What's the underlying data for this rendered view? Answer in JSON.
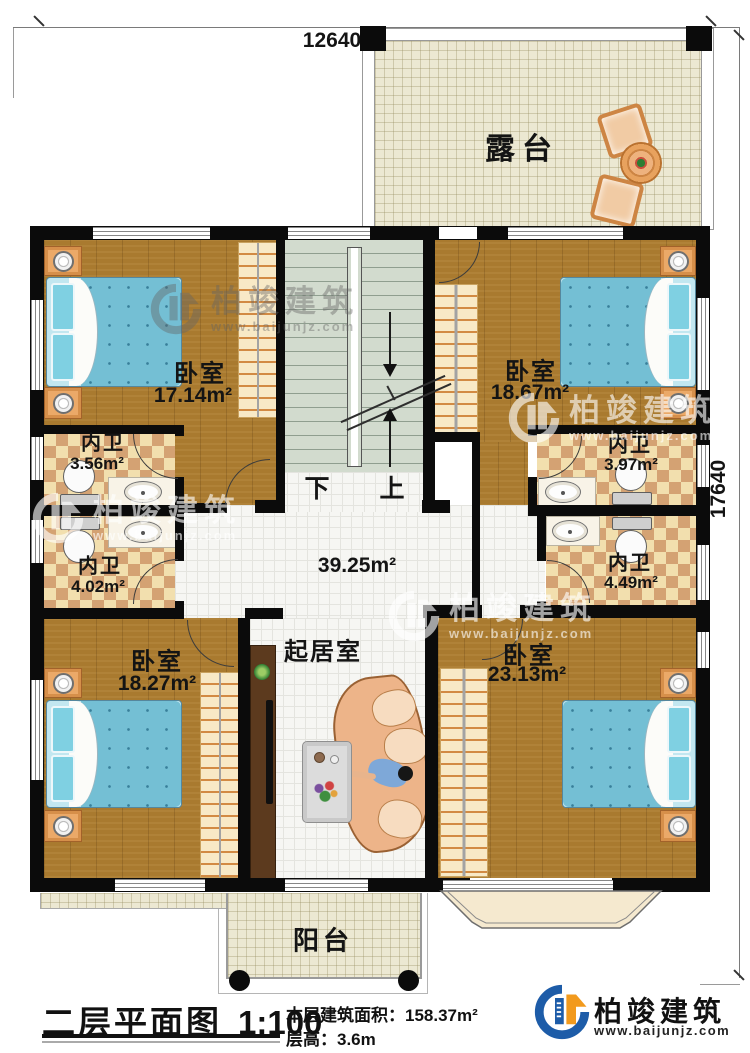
{
  "dimensions": {
    "width": "12640",
    "height": "17640"
  },
  "rooms": {
    "terrace": {
      "name": "露台"
    },
    "bedroom_top_left": {
      "name": "卧室",
      "area": "17.14m²"
    },
    "bedroom_top_right": {
      "name": "卧室",
      "area": "18.67m²"
    },
    "bath_left_upper": {
      "name": "内卫",
      "area": "3.56m²"
    },
    "bath_left_lower": {
      "name": "内卫",
      "area": "4.02m²"
    },
    "bath_right_upper": {
      "name": "内卫",
      "area": "3.97m²"
    },
    "bath_right_lower": {
      "name": "内卫",
      "area": "4.49m²"
    },
    "hall": {
      "area": "39.25m²"
    },
    "living_room": {
      "name": "起居室"
    },
    "bedroom_bottom_left": {
      "name": "卧室",
      "area": "18.27m²"
    },
    "bedroom_bottom_right": {
      "name": "卧室",
      "area": "23.13m²"
    },
    "balcony": {
      "name": "阳台"
    }
  },
  "stairs": {
    "down": "下",
    "up": "上"
  },
  "title_block": {
    "title": "二层平面图",
    "scale": "1:100",
    "floor_area_label": "本层建筑面积：",
    "floor_area_value": "158.37m²",
    "floor_height_label": "层高：",
    "floor_height_value": "3.6m"
  },
  "brand": {
    "name": "柏竣建筑",
    "website": "www.baijunjz.com"
  },
  "watermark": {
    "name": "柏竣建筑",
    "website": "www.baijunjz.com"
  },
  "colors": {
    "wall": "#0b0b0b",
    "wood_floor": "#a97a2f",
    "terrace_floor": "#ece8d2",
    "stair_floor": "#d2dbce",
    "bath_tile_dark": "#d4a273",
    "bath_tile_light": "#f2dfae",
    "bed_blue": "#74bfd4",
    "furniture_orange": "#eba968",
    "logo_blue": "#1d5ca8",
    "logo_orange": "#f29a1d"
  }
}
